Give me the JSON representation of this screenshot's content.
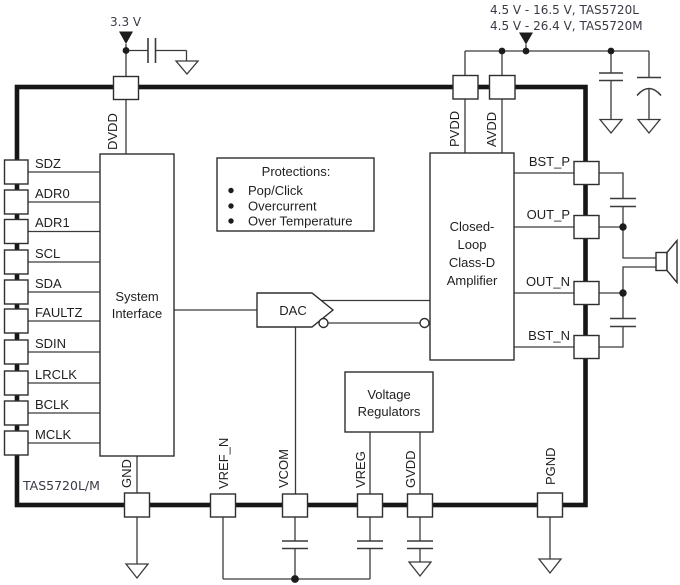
{
  "title": "TAS5720L/M functional block diagram",
  "colors": {
    "line": "#3a3a3a",
    "border": "#161616",
    "text": "#1f1f1f",
    "supply_text": "#3a3a46",
    "bg": "#ffffff"
  },
  "supplies": {
    "dvdd": "3.3 V",
    "pvdd_l": "4.5 V - 16.5 V, TAS5720L",
    "pvdd_m": "4.5 V - 26.4 V, TAS5720M"
  },
  "chip": {
    "part_label": "TAS5720L/M",
    "left_pins": [
      "SDZ",
      "ADR0",
      "ADR1",
      "SCL",
      "SDA",
      "FAULTZ",
      "SDIN",
      "LRCLK",
      "BCLK",
      "MCLK"
    ],
    "top_pins": [
      "DVDD",
      "PVDD",
      "AVDD"
    ],
    "right_pins": [
      "BST_P",
      "OUT_P",
      "OUT_N",
      "BST_N"
    ],
    "bottom_pins": [
      "GND",
      "VREF_N",
      "VCOM",
      "VREG",
      "GVDD",
      "PGND"
    ],
    "blocks": {
      "system_interface": [
        "System",
        "Interface"
      ],
      "dac": "DAC",
      "amplifier": [
        "Closed-",
        "Loop",
        "Class-D",
        "Amplifier"
      ],
      "voltage_regulators": [
        "Voltage",
        "Regulators"
      ],
      "protections_title": "Protections:",
      "protections_items": [
        "Pop/Click",
        "Overcurrent",
        "Over Temperature"
      ]
    }
  }
}
